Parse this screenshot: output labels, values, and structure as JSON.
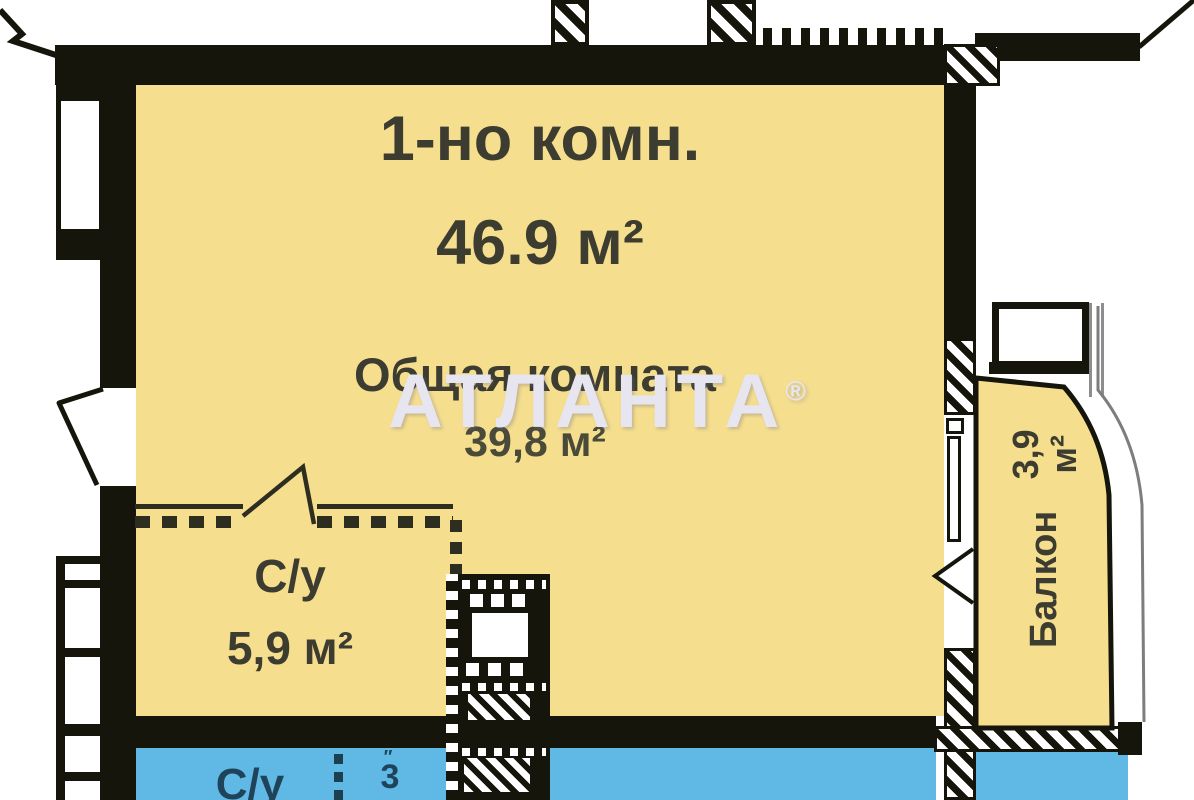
{
  "plan": {
    "type_label": "1-но комн.",
    "total_area": "46.9 м²",
    "rooms": [
      {
        "name": "Общая комната",
        "area": "39,8 м²"
      },
      {
        "name": "С/у",
        "area": "5,9 м²"
      },
      {
        "name": "Балкон",
        "area": "3,9 м²"
      }
    ],
    "neighbor": {
      "label": "С/у",
      "area_digit": "3",
      "mark": "″"
    },
    "watermark": {
      "text": "АТЛАНТА",
      "mark": "®"
    },
    "colors": {
      "room_fill": "#F5DE8E",
      "neighbor_fill": "#5FB9E4",
      "wall": "#15150C",
      "watermark": "#E7E5F0",
      "label_text": "#3C3C30"
    }
  }
}
